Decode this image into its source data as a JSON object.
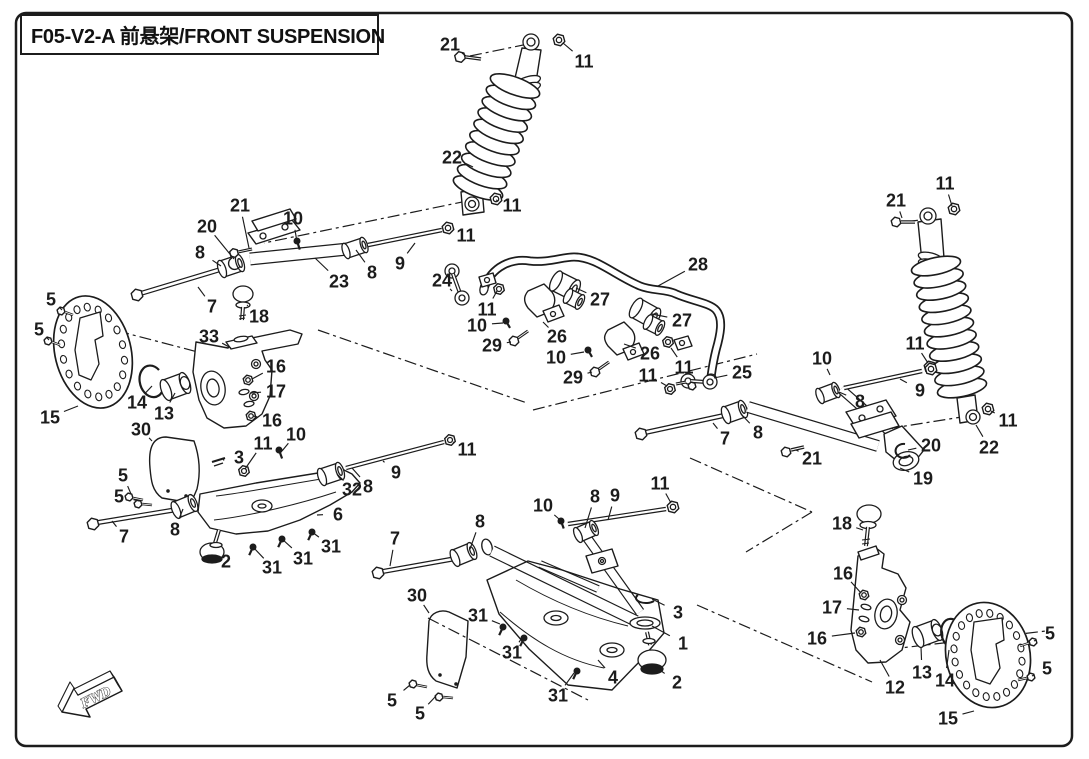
{
  "page": {
    "background": "#ffffff",
    "line_color": "#1c1c1c"
  },
  "header": {
    "title": "F05-V2-A 前悬架/FRONT SUSPENSION"
  },
  "direction_marker": {
    "label": "FWD"
  },
  "diagram": {
    "type": "exploded-parts-diagram",
    "subject": "front-suspension",
    "part_labels": [
      {
        "n": "21",
        "x": 450,
        "y": 44,
        "lx": 466,
        "ly": 56
      },
      {
        "n": "11",
        "x": 584,
        "y": 61,
        "lx": 563,
        "ly": 43
      },
      {
        "n": "22",
        "x": 452,
        "y": 157,
        "lx": 473,
        "ly": 167
      },
      {
        "n": "11",
        "x": 512,
        "y": 205,
        "lx": 496,
        "ly": 200
      },
      {
        "n": "21",
        "x": 240,
        "y": 205,
        "lx": 249,
        "ly": 248
      },
      {
        "n": "20",
        "x": 207,
        "y": 226,
        "lx": 234,
        "ly": 259
      },
      {
        "n": "10",
        "x": 293,
        "y": 218,
        "lx": 297,
        "ly": 242
      },
      {
        "n": "8",
        "x": 200,
        "y": 252,
        "lx": 221,
        "ly": 266
      },
      {
        "n": "11",
        "x": 466,
        "y": 235,
        "lx": 452,
        "ly": 229
      },
      {
        "n": "9",
        "x": 400,
        "y": 263,
        "lx": 415,
        "ly": 243
      },
      {
        "n": "23",
        "x": 339,
        "y": 281,
        "lx": 315,
        "ly": 258
      },
      {
        "n": "8",
        "x": 372,
        "y": 272,
        "lx": 356,
        "ly": 250
      },
      {
        "n": "7",
        "x": 212,
        "y": 306,
        "lx": 198,
        "ly": 287
      },
      {
        "n": "18",
        "x": 259,
        "y": 316,
        "lx": 247,
        "ly": 305
      },
      {
        "n": "33",
        "x": 209,
        "y": 336,
        "lx": 231,
        "ly": 348
      },
      {
        "n": "5",
        "x": 51,
        "y": 299,
        "lx": 62,
        "ly": 310
      },
      {
        "n": "5",
        "x": 39,
        "y": 329,
        "lx": 49,
        "ly": 340
      },
      {
        "n": "15",
        "x": 50,
        "y": 417,
        "lx": 78,
        "ly": 406
      },
      {
        "n": "14",
        "x": 137,
        "y": 402,
        "lx": 152,
        "ly": 386
      },
      {
        "n": "13",
        "x": 164,
        "y": 413,
        "lx": 175,
        "ly": 393
      },
      {
        "n": "16",
        "x": 276,
        "y": 366,
        "lx": 252,
        "ly": 379
      },
      {
        "n": "17",
        "x": 276,
        "y": 391,
        "lx": 251,
        "ly": 393
      },
      {
        "n": "16",
        "x": 272,
        "y": 420,
        "lx": 253,
        "ly": 416
      },
      {
        "n": "30",
        "x": 141,
        "y": 429,
        "lx": 152,
        "ly": 441
      },
      {
        "n": "11",
        "x": 263,
        "y": 443,
        "lx": 245,
        "ly": 469
      },
      {
        "n": "3",
        "x": 239,
        "y": 457,
        "lx": 223,
        "ly": 460
      },
      {
        "n": "24",
        "x": 442,
        "y": 280,
        "lx": 452,
        "ly": 291
      },
      {
        "n": "11",
        "x": 487,
        "y": 309,
        "lx": 497,
        "ly": 291
      },
      {
        "n": "10",
        "x": 477,
        "y": 325,
        "lx": 503,
        "ly": 323
      },
      {
        "n": "29",
        "x": 492,
        "y": 345,
        "lx": 511,
        "ly": 342
      },
      {
        "n": "26",
        "x": 557,
        "y": 336,
        "lx": 543,
        "ly": 322
      },
      {
        "n": "27",
        "x": 600,
        "y": 299,
        "lx": 576,
        "ly": 288
      },
      {
        "n": "28",
        "x": 698,
        "y": 264,
        "lx": 658,
        "ly": 286
      },
      {
        "n": "27",
        "x": 682,
        "y": 320,
        "lx": 652,
        "ly": 314
      },
      {
        "n": "26",
        "x": 650,
        "y": 353,
        "lx": 624,
        "ly": 344
      },
      {
        "n": "10",
        "x": 556,
        "y": 357,
        "lx": 584,
        "ly": 352
      },
      {
        "n": "29",
        "x": 573,
        "y": 377,
        "lx": 592,
        "ly": 372
      },
      {
        "n": "11",
        "x": 648,
        "y": 375,
        "lx": 667,
        "ly": 386
      },
      {
        "n": "11",
        "x": 684,
        "y": 367,
        "lx": 671,
        "ly": 348
      },
      {
        "n": "25",
        "x": 742,
        "y": 372,
        "lx": 714,
        "ly": 378
      },
      {
        "n": "21",
        "x": 896,
        "y": 200,
        "lx": 902,
        "ly": 218
      },
      {
        "n": "11",
        "x": 945,
        "y": 183,
        "lx": 952,
        "ly": 206
      },
      {
        "n": "11",
        "x": 915,
        "y": 343,
        "lx": 928,
        "ly": 363
      },
      {
        "n": "9",
        "x": 920,
        "y": 390,
        "lx": 900,
        "ly": 379
      },
      {
        "n": "8",
        "x": 860,
        "y": 401,
        "lx": 839,
        "ly": 392
      },
      {
        "n": "22",
        "x": 989,
        "y": 447,
        "lx": 976,
        "ly": 425
      },
      {
        "n": "11",
        "x": 1008,
        "y": 420,
        "lx": 991,
        "ly": 411
      },
      {
        "n": "20",
        "x": 931,
        "y": 445,
        "lx": 908,
        "ly": 450
      },
      {
        "n": "10",
        "x": 822,
        "y": 358,
        "lx": 830,
        "ly": 375
      },
      {
        "n": "7",
        "x": 725,
        "y": 438,
        "lx": 713,
        "ly": 423
      },
      {
        "n": "8",
        "x": 758,
        "y": 432,
        "lx": 741,
        "ly": 414
      },
      {
        "n": "21",
        "x": 812,
        "y": 458,
        "lx": 796,
        "ly": 450
      },
      {
        "n": "19",
        "x": 923,
        "y": 478,
        "lx": 900,
        "ly": 468
      },
      {
        "n": "11",
        "x": 660,
        "y": 483,
        "lx": 671,
        "ly": 503
      },
      {
        "n": "5",
        "x": 123,
        "y": 475,
        "lx": 131,
        "ly": 494
      },
      {
        "n": "5",
        "x": 119,
        "y": 496,
        "lx": 139,
        "ly": 501
      },
      {
        "n": "7",
        "x": 124,
        "y": 536,
        "lx": 112,
        "ly": 521
      },
      {
        "n": "8",
        "x": 175,
        "y": 529,
        "lx": 183,
        "ly": 509
      },
      {
        "n": "2",
        "x": 226,
        "y": 561,
        "lx": 215,
        "ly": 554
      },
      {
        "n": "10",
        "x": 296,
        "y": 434,
        "lx": 282,
        "ly": 451
      },
      {
        "n": "11",
        "x": 467,
        "y": 449,
        "lx": 453,
        "ly": 442
      },
      {
        "n": "9",
        "x": 396,
        "y": 472,
        "lx": 383,
        "ly": 461
      },
      {
        "n": "32",
        "x": 352,
        "y": 489,
        "lx": 337,
        "ly": 474
      },
      {
        "n": "8",
        "x": 368,
        "y": 486,
        "lx": 352,
        "ly": 468
      },
      {
        "n": "6",
        "x": 338,
        "y": 514,
        "lx": 317,
        "ly": 515
      },
      {
        "n": "31",
        "x": 272,
        "y": 567,
        "lx": 253,
        "ly": 547
      },
      {
        "n": "31",
        "x": 303,
        "y": 558,
        "lx": 282,
        "ly": 539
      },
      {
        "n": "31",
        "x": 331,
        "y": 546,
        "lx": 312,
        "ly": 532
      },
      {
        "n": "7",
        "x": 395,
        "y": 538,
        "lx": 390,
        "ly": 566
      },
      {
        "n": "8",
        "x": 480,
        "y": 521,
        "lx": 470,
        "ly": 549
      },
      {
        "n": "10",
        "x": 543,
        "y": 505,
        "lx": 559,
        "ly": 519
      },
      {
        "n": "8",
        "x": 595,
        "y": 496,
        "lx": 585,
        "ly": 528
      },
      {
        "n": "9",
        "x": 615,
        "y": 495,
        "lx": 608,
        "ly": 520
      },
      {
        "n": "30",
        "x": 417,
        "y": 595,
        "lx": 429,
        "ly": 613
      },
      {
        "n": "31",
        "x": 478,
        "y": 615,
        "lx": 500,
        "ly": 624
      },
      {
        "n": "31",
        "x": 512,
        "y": 652,
        "lx": 522,
        "ly": 638
      },
      {
        "n": "31",
        "x": 558,
        "y": 695,
        "lx": 574,
        "ly": 673
      },
      {
        "n": "5",
        "x": 392,
        "y": 700,
        "lx": 410,
        "ly": 685
      },
      {
        "n": "5",
        "x": 420,
        "y": 713,
        "lx": 436,
        "ly": 696
      },
      {
        "n": "3",
        "x": 678,
        "y": 612,
        "lx": 652,
        "ly": 599
      },
      {
        "n": "1",
        "x": 683,
        "y": 643,
        "lx": 652,
        "ly": 626
      },
      {
        "n": "2",
        "x": 677,
        "y": 682,
        "lx": 654,
        "ly": 666
      },
      {
        "n": "4",
        "x": 613,
        "y": 677,
        "lx": 598,
        "ly": 660
      },
      {
        "n": "18",
        "x": 842,
        "y": 523,
        "lx": 863,
        "ly": 530
      },
      {
        "n": "16",
        "x": 843,
        "y": 573,
        "lx": 861,
        "ly": 593
      },
      {
        "n": "17",
        "x": 832,
        "y": 607,
        "lx": 859,
        "ly": 610
      },
      {
        "n": "16",
        "x": 817,
        "y": 638,
        "lx": 855,
        "ly": 633
      },
      {
        "n": "12",
        "x": 895,
        "y": 687,
        "lx": 880,
        "ly": 660
      },
      {
        "n": "13",
        "x": 922,
        "y": 672,
        "lx": 921,
        "ly": 647
      },
      {
        "n": "14",
        "x": 945,
        "y": 680,
        "lx": 949,
        "ly": 650
      },
      {
        "n": "15",
        "x": 948,
        "y": 718,
        "lx": 974,
        "ly": 711
      },
      {
        "n": "5",
        "x": 1050,
        "y": 633,
        "lx": 1034,
        "ly": 641
      },
      {
        "n": "5",
        "x": 1047,
        "y": 668,
        "lx": 1032,
        "ly": 676
      }
    ]
  }
}
